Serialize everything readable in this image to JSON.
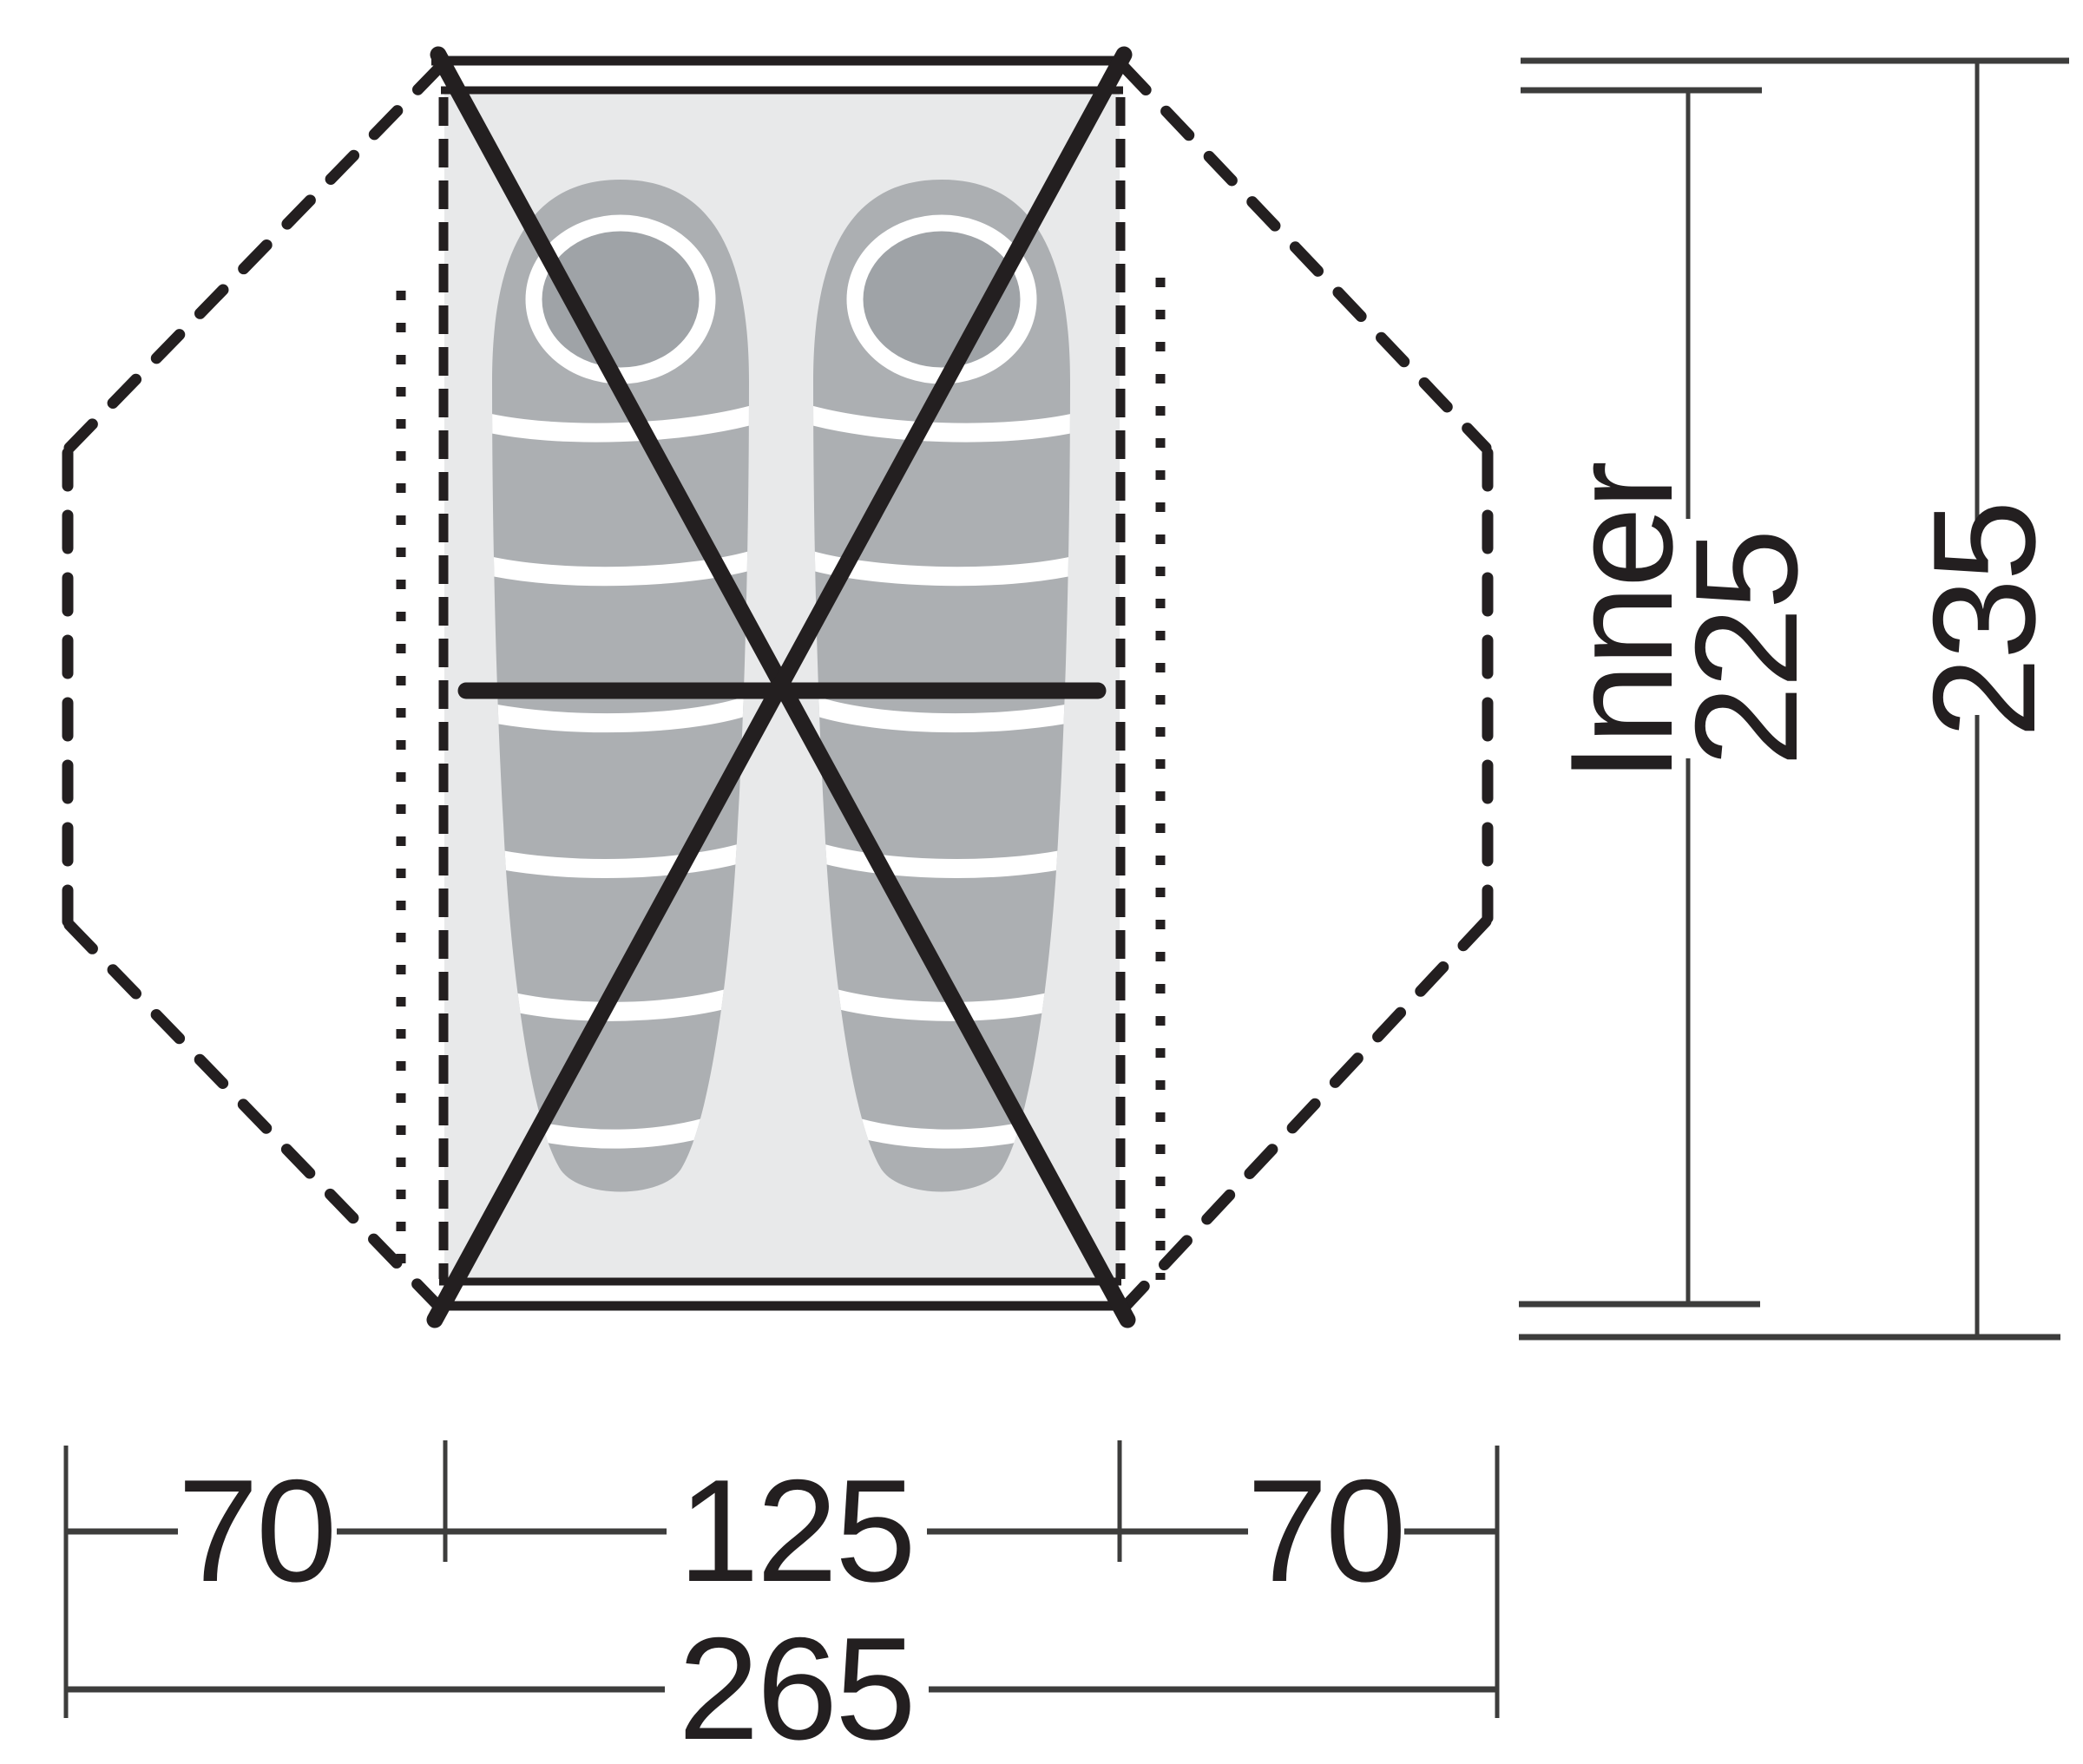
{
  "diagram": {
    "kind": "tent-floorplan-top-view",
    "sleeping_bags_count": "2"
  },
  "dimensions": {
    "inner_label": "Inner",
    "inner_length_cm": "225",
    "outer_length_cm": "235",
    "left_porch_cm": "70",
    "inner_width_cm": "125",
    "right_porch_cm": "70",
    "total_width_cm": "265"
  },
  "colors": {
    "line_black": "#231f20",
    "dim_line_gray": "#3d3d3c",
    "floor_fill": "#e8e9ea",
    "sleeping_bag_fill": "#acafb2",
    "hood_inner_fill": "#9fa3a7",
    "stripe_white": "#ffffff",
    "background": "#ffffff"
  }
}
